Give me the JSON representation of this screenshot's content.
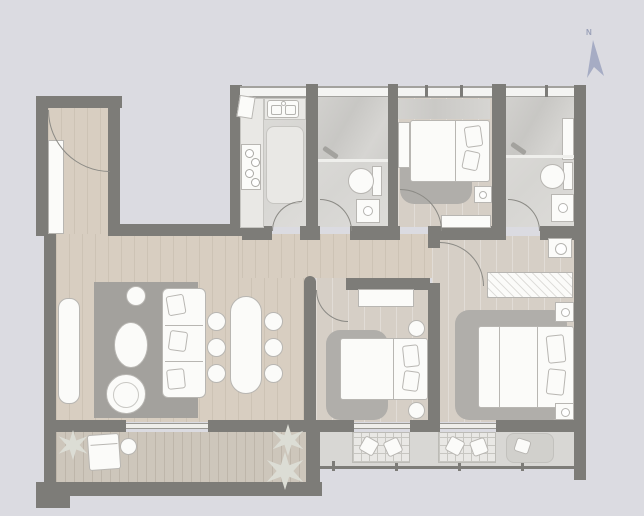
{
  "compass": {
    "label": "N"
  },
  "colors": {
    "background": "#dbdbe1",
    "wall": "#7d7c78",
    "wall_light": "#a3a29e",
    "wood_floor": "#d8cec1",
    "wood_line": "#cdc3b5",
    "bedroom_floor": "#d6cfc6",
    "marble_floor": "#dbdad7",
    "rug_dark": "#a3a19d",
    "rug_light": "#b0aeaa",
    "furniture_white": "#fbfbf9",
    "furniture_border": "#b8b6b2",
    "glass_window": "#f4f4f2",
    "deck_floor": "#cdc6bb",
    "balcony_floor": "#d8d7d4",
    "plant": "#dcddd5",
    "north_arrow": "#a6acc4",
    "north_text": "#9aa0b8",
    "arc_line": "#8b8a85"
  }
}
